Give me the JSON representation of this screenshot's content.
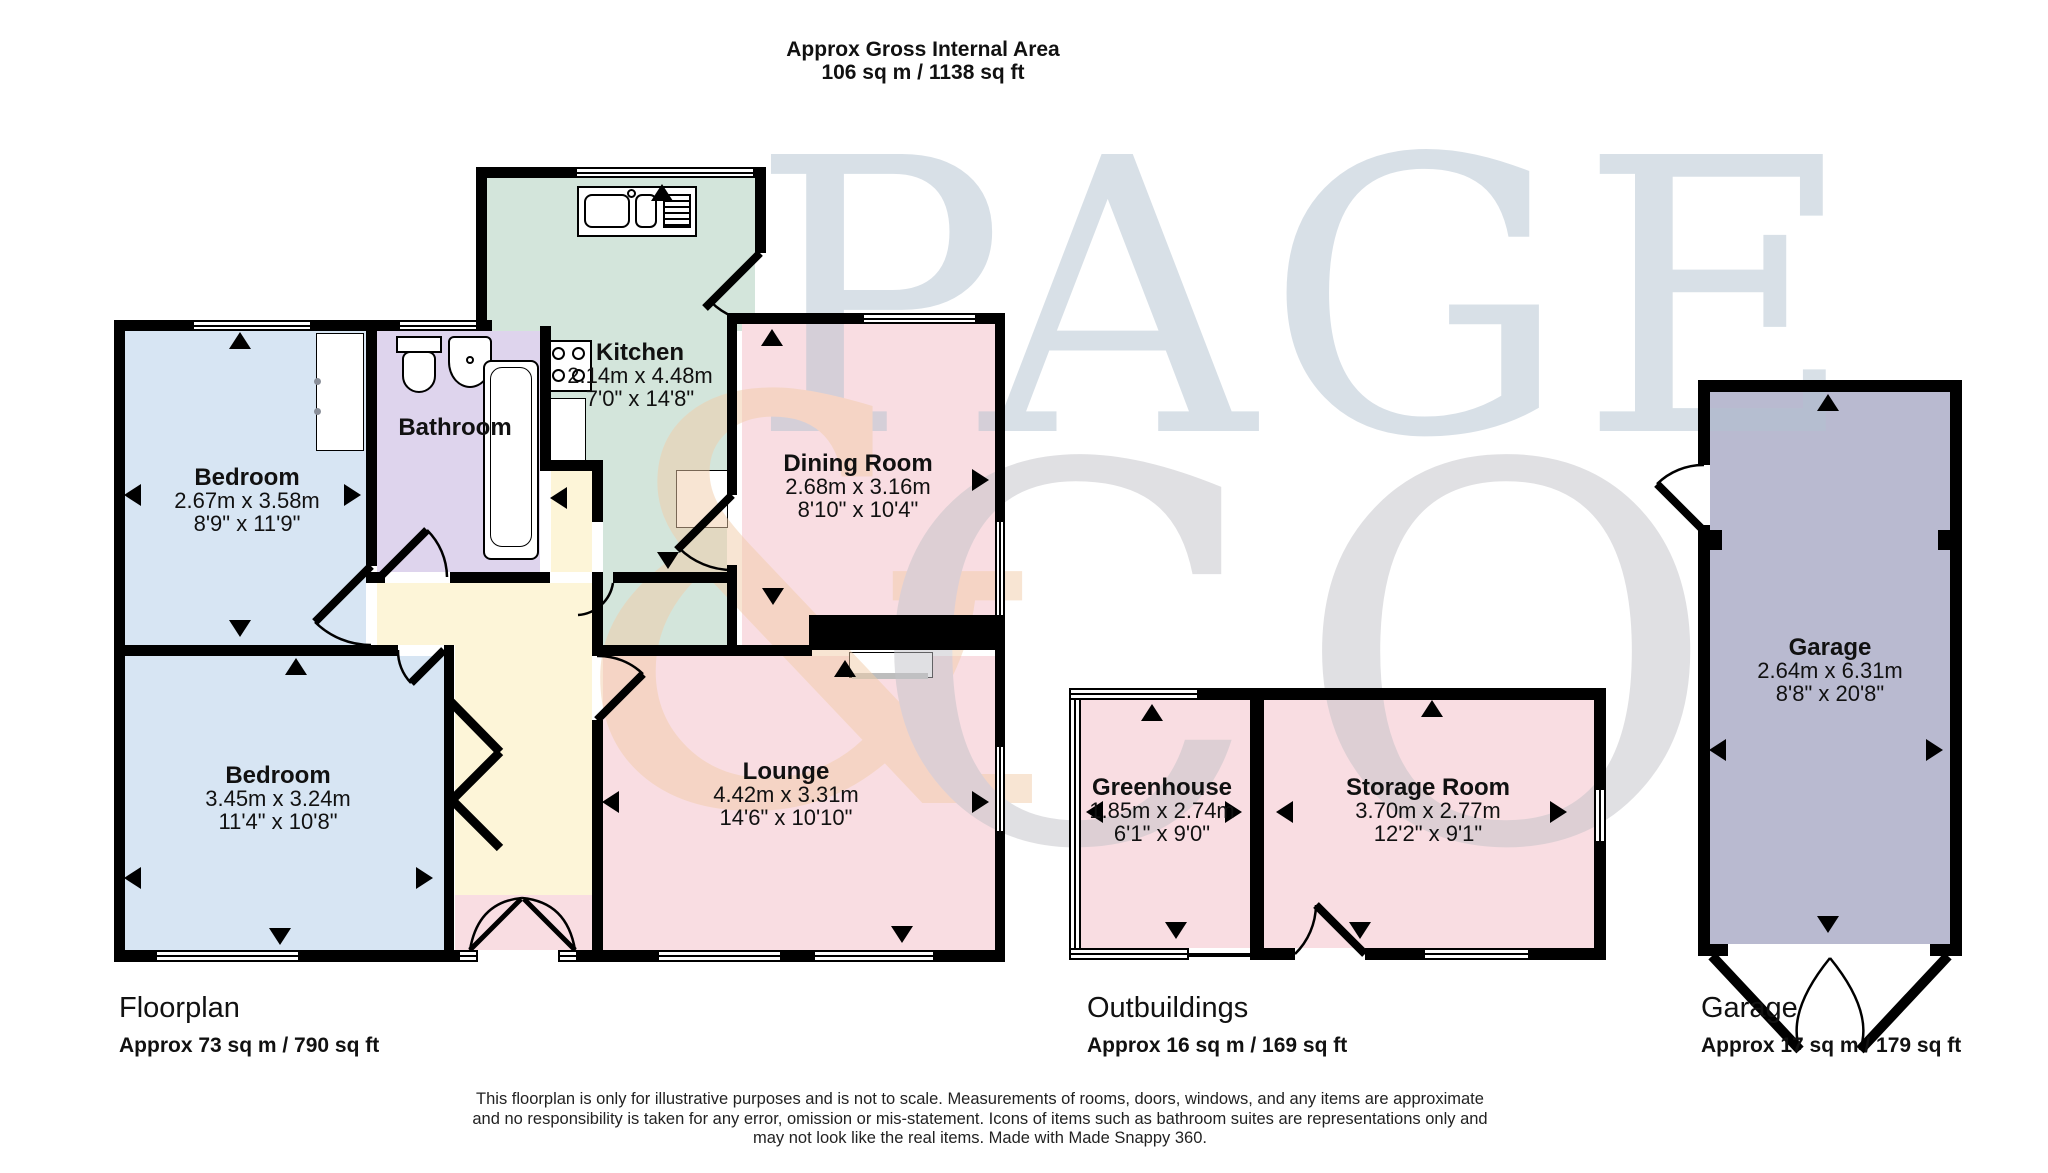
{
  "title": {
    "line1": "Approx Gross Internal Area",
    "line2": "106 sq m / 1138 sq ft"
  },
  "watermark": {
    "word1": "PAGE",
    "amp": "&",
    "word2": "CO"
  },
  "rooms": [
    {
      "id": "bedroom-1",
      "name": "Bedroom",
      "metric": "2.67m x 3.58m",
      "imperial": "8'9\" x 11'9\""
    },
    {
      "id": "bedroom-2",
      "name": "Bedroom",
      "metric": "3.45m x 3.24m",
      "imperial": "11'4\" x 10'8\""
    },
    {
      "id": "bathroom",
      "name": "Bathroom",
      "metric": "",
      "imperial": ""
    },
    {
      "id": "kitchen",
      "name": "Kitchen",
      "metric": "2.14m x 4.48m",
      "imperial": "7'0\" x 14'8\""
    },
    {
      "id": "dining-room",
      "name": "Dining Room",
      "metric": "2.68m x 3.16m",
      "imperial": "8'10\" x 10'4\""
    },
    {
      "id": "lounge",
      "name": "Lounge",
      "metric": "4.42m x 3.31m",
      "imperial": "14'6\" x 10'10\""
    },
    {
      "id": "greenhouse",
      "name": "Greenhouse",
      "metric": "1.85m x 2.74m",
      "imperial": "6'1\" x 9'0\""
    },
    {
      "id": "storage-room",
      "name": "Storage Room",
      "metric": "3.70m x 2.77m",
      "imperial": "12'2\" x 9'1\""
    },
    {
      "id": "garage",
      "name": "Garage",
      "metric": "2.64m x 6.31m",
      "imperial": "8'8\" x 20'8\""
    }
  ],
  "sections": [
    {
      "label": "Floorplan",
      "area": "Approx 73 sq m / 790 sq ft"
    },
    {
      "label": "Outbuildings",
      "area": "Approx 16 sq m / 169 sq ft"
    },
    {
      "label": "Garage",
      "area": "Approx 17 sq m / 179 sq ft"
    }
  ],
  "disclaimer": {
    "line1": "This floorplan is only for illustrative purposes and is not to scale. Measurements of rooms, doors, windows, and any items are approximate",
    "line2": "and no responsibility is taken for any error, omission or mis-statement. Icons of items such as bathroom suites are representations only and",
    "line3": "may not look like the real items. Made with Made Snappy 360."
  },
  "colors": {
    "bedroom": "#d7e5f3",
    "bathroom": "#ded4ed",
    "kitchen": "#d3e5db",
    "living": "#f9dde2",
    "hallway": "#fdf5d8",
    "garage": "#b9bad0",
    "wall": "#000000",
    "watermark_blue": "#b3c2d0",
    "watermark_orange": "#f2cda9",
    "watermark_grey": "#c3c3c8"
  }
}
